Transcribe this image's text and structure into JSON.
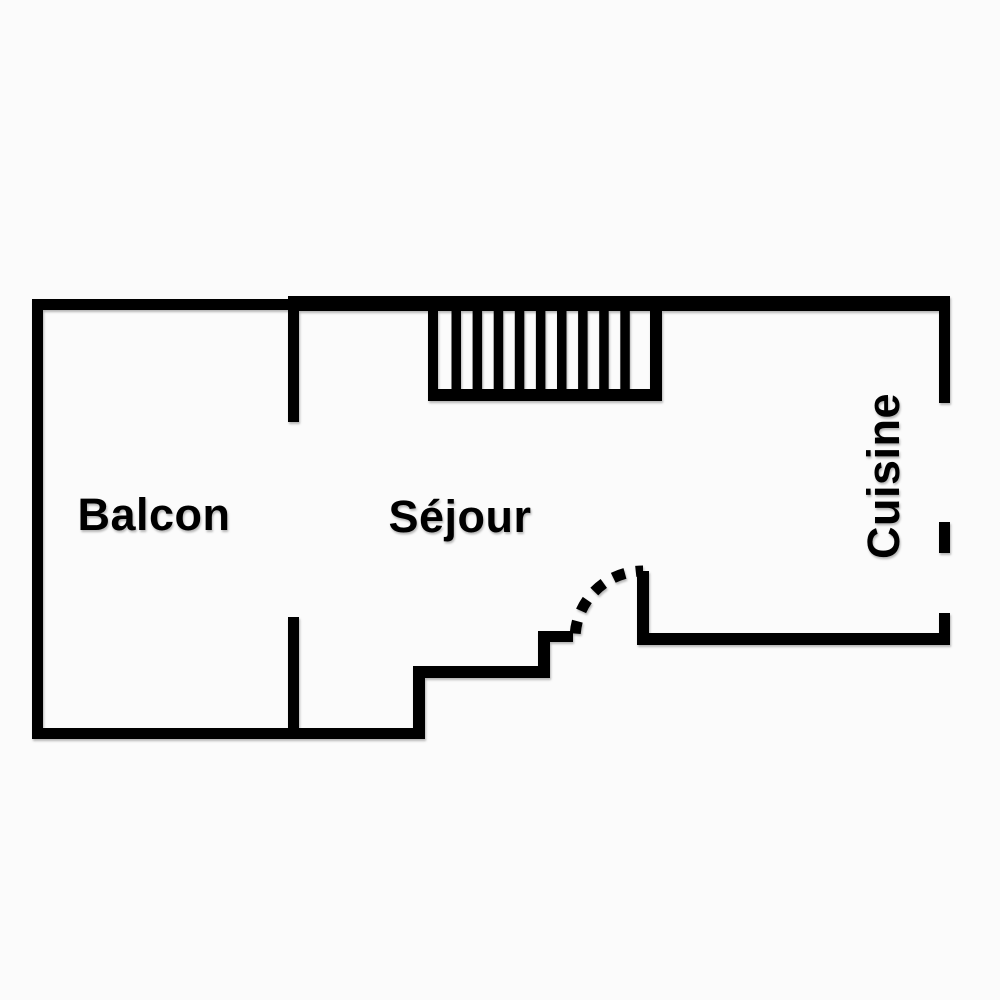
{
  "rooms": [
    {
      "id": "balcon",
      "label": "Balcon"
    },
    {
      "id": "sejour",
      "label": "Séjour"
    },
    {
      "id": "cuisine",
      "label": "Cuisine"
    }
  ],
  "staircase": {
    "tread_count": 9
  },
  "colors": {
    "wall": "#000000",
    "background": "#fbfbfb"
  }
}
